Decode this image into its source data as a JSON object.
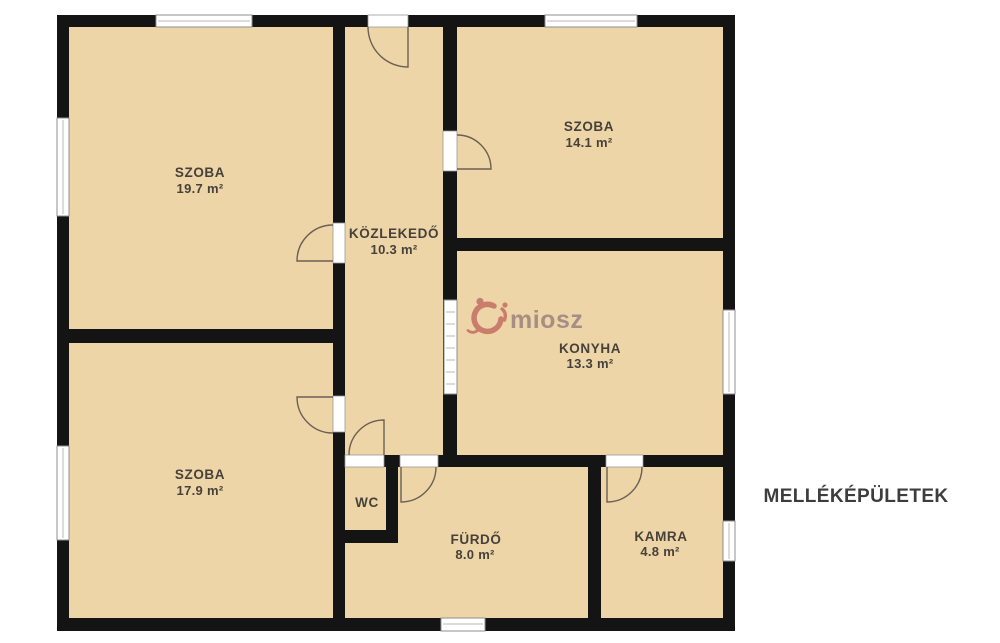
{
  "watermark": {
    "brand": "miosz"
  },
  "side_label": {
    "text": "MELLÉKÉPÜLETEK"
  },
  "rooms": {
    "szoba_19": {
      "name": "SZOBA",
      "area": "19.7 m²"
    },
    "szoba_14": {
      "name": "SZOBA",
      "area": "14.1 m²"
    },
    "kozlekedo": {
      "name": "KÖZLEKEDŐ",
      "area": "10.3 m²"
    },
    "konyha": {
      "name": "KONYHA",
      "area": "13.3 m²"
    },
    "szoba_17": {
      "name": "SZOBA",
      "area": "17.9 m²"
    },
    "wc": {
      "name": "WC"
    },
    "furdo": {
      "name": "FÜRDŐ",
      "area": "8.0 m²"
    },
    "kamra": {
      "name": "KAMRA",
      "area": "4.8 m²"
    }
  },
  "colors": {
    "floor": "#eed5a8",
    "wall": "#141414",
    "window_frame": "#8f8f8f",
    "door_arc": "#6a6054",
    "label_text": "#46413a",
    "side_label_text": "#3d3d3d",
    "logo_icon": "#c8796a",
    "logo_text": "#a48b83"
  }
}
